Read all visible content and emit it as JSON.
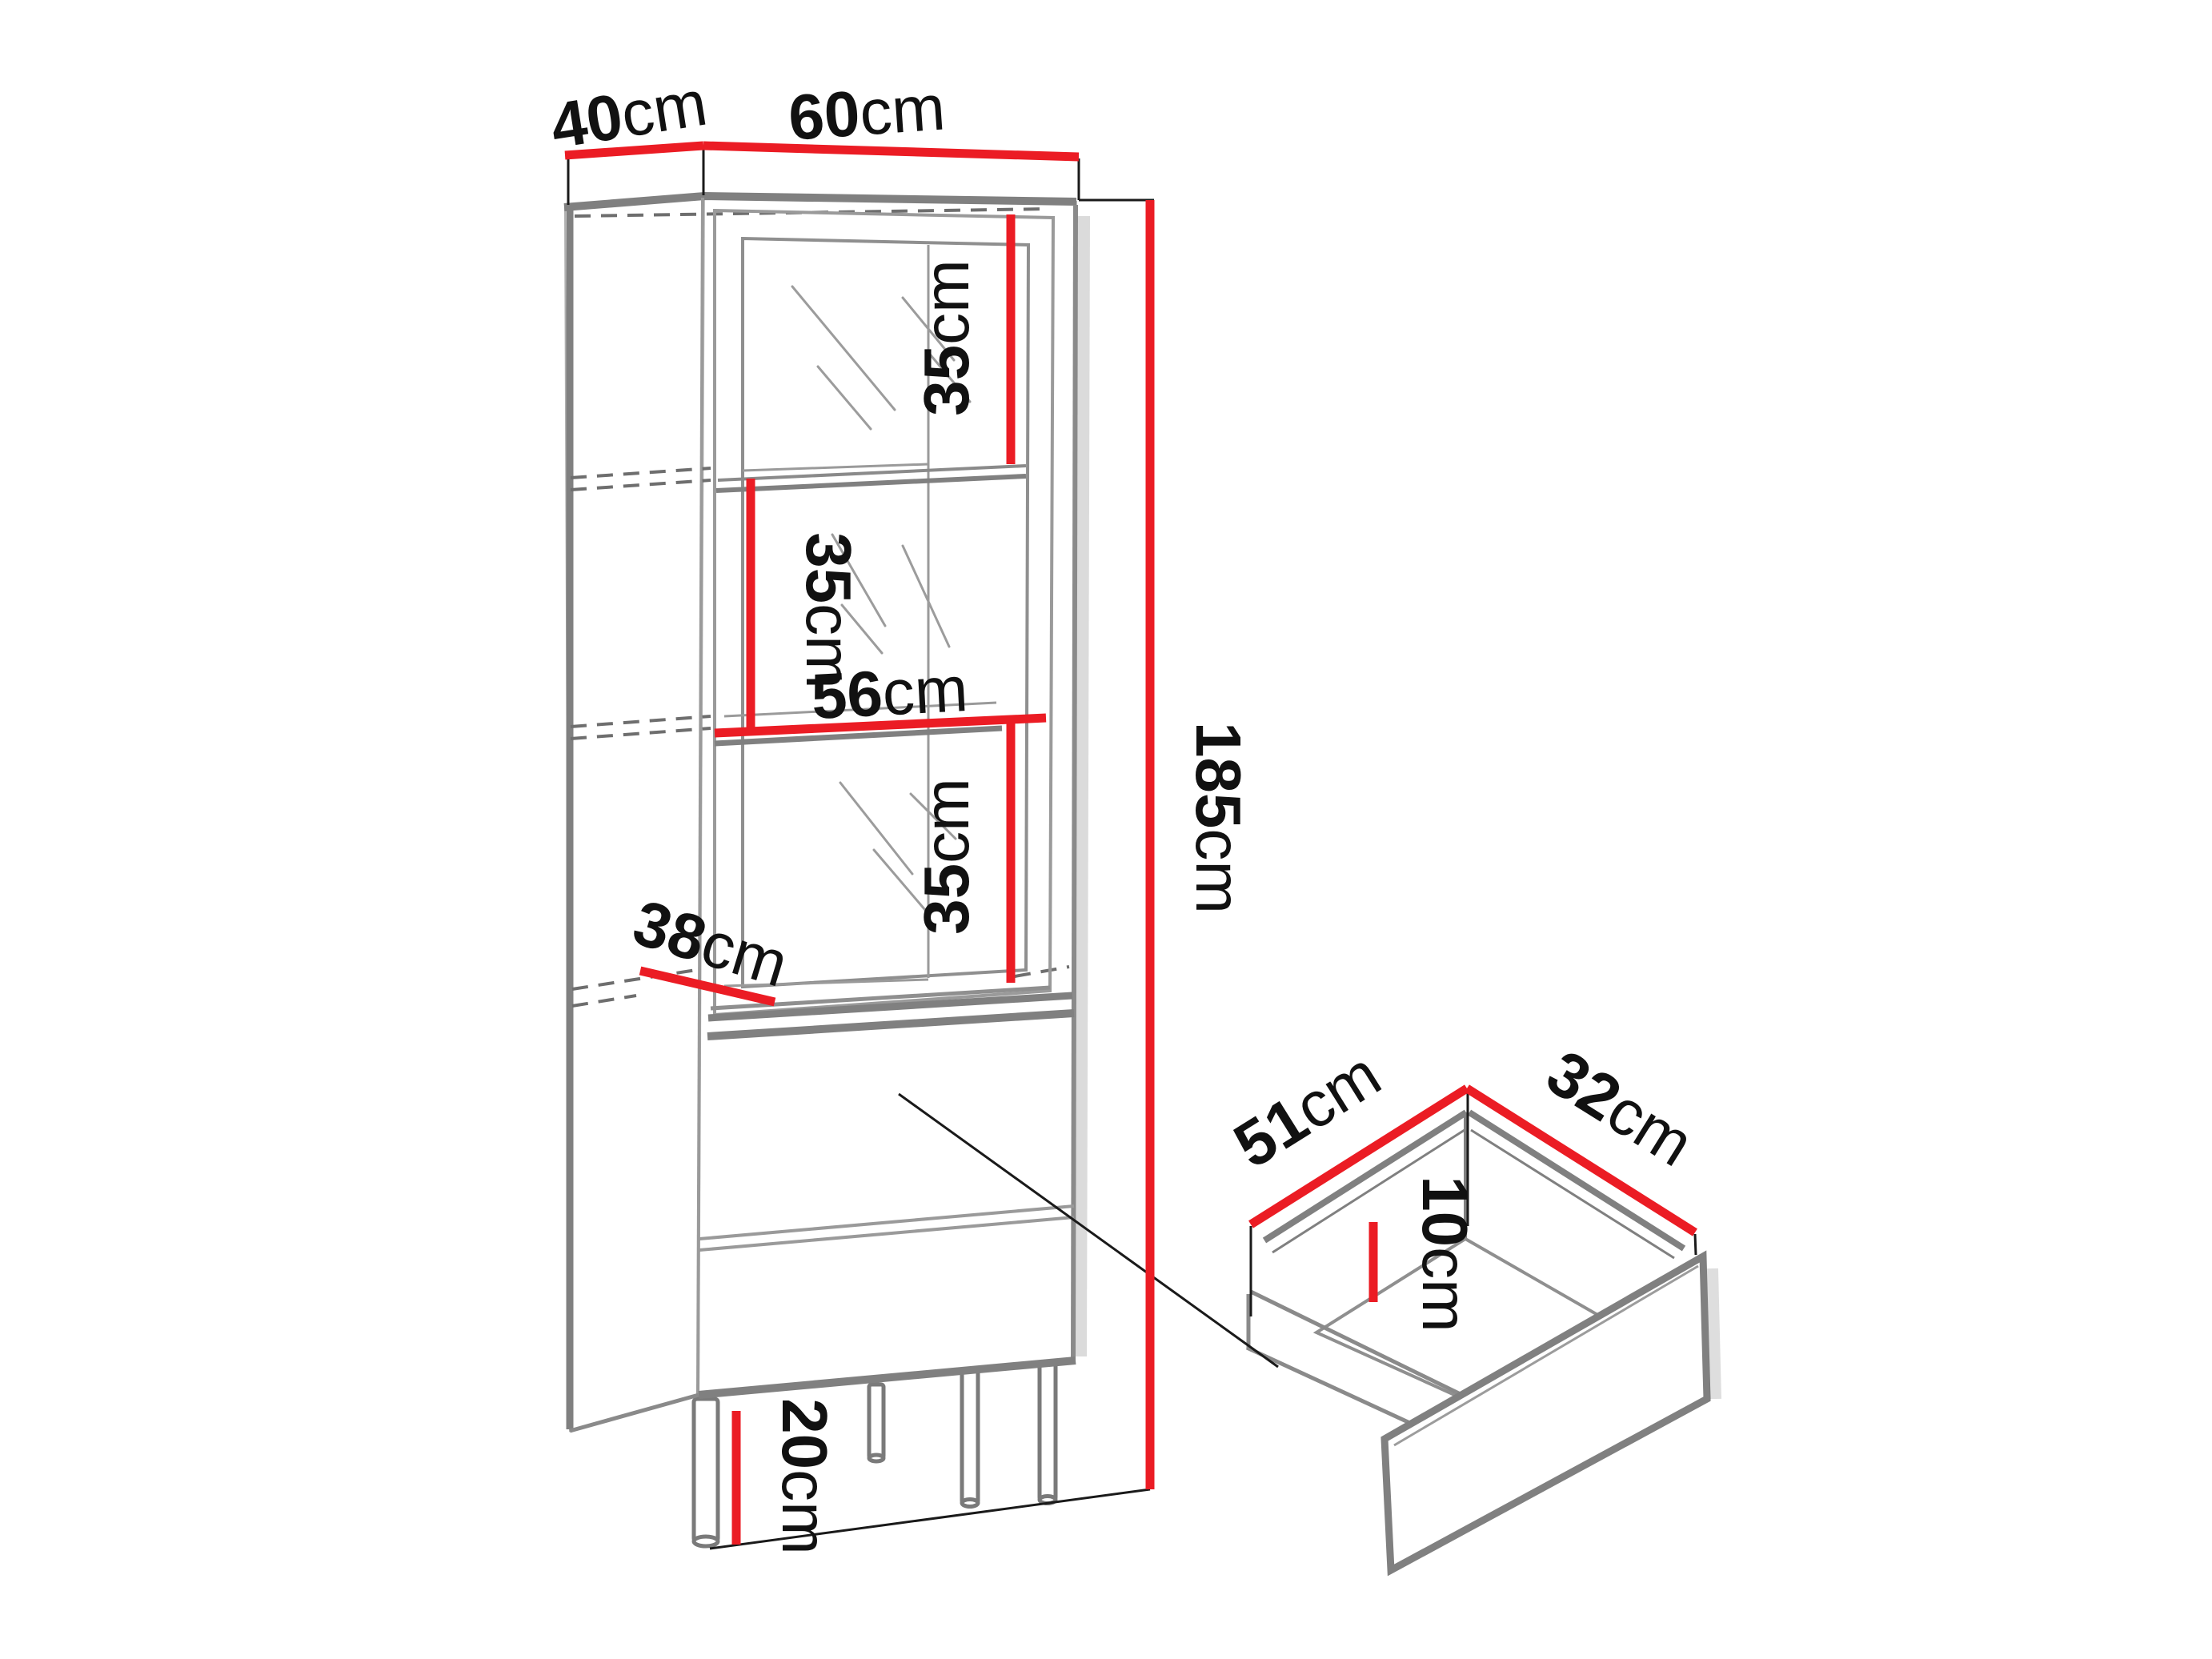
{
  "title": "Cabinet dimension diagram",
  "colors": {
    "dimension_line": "#EB1C24",
    "outline_gray": "#808080",
    "label_text": "#111111"
  },
  "cabinet": {
    "top_depth": {
      "value": "40",
      "unit": "cm"
    },
    "top_width": {
      "value": "60",
      "unit": "cm"
    },
    "section_top_height": {
      "value": "35",
      "unit": "cm"
    },
    "section_middle_height": {
      "value": "35",
      "unit": "cm"
    },
    "shelf_width": {
      "value": "56",
      "unit": "cm"
    },
    "section_bottom_height": {
      "value": "35",
      "unit": "cm"
    },
    "shelf_depth": {
      "value": "38",
      "unit": "cm"
    },
    "total_height": {
      "value": "185",
      "unit": "cm"
    },
    "leg_height": {
      "value": "20",
      "unit": "cm"
    }
  },
  "drawer": {
    "depth": {
      "value": "51",
      "unit": "cm"
    },
    "width": {
      "value": "32",
      "unit": "cm"
    },
    "inner_height": {
      "value": "10",
      "unit": "cm"
    }
  }
}
